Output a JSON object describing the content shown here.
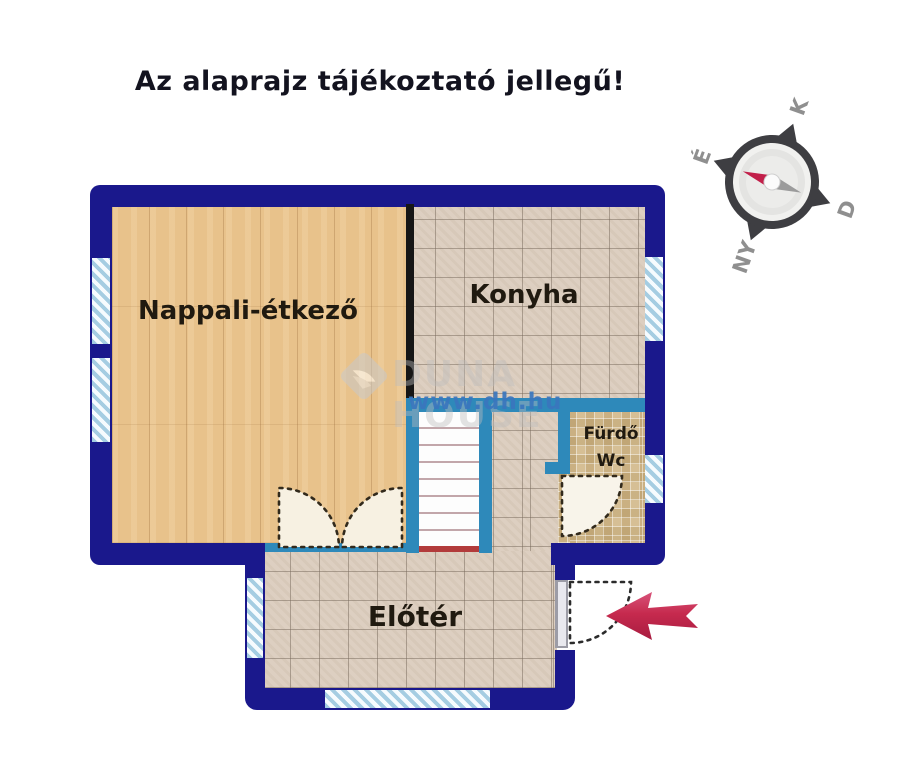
{
  "title": "Az alaprajz tájékoztató jellegű!",
  "compass": {
    "labels": {
      "north": "É",
      "east": "K",
      "south": "D",
      "west": "NY"
    },
    "needle_color": "#c2204a"
  },
  "rooms": {
    "living": {
      "label": "Nappali-étkező",
      "floor": "wood"
    },
    "kitchen": {
      "label": "Konyha",
      "floor": "tile"
    },
    "bathroom": {
      "label_line1": "Fürdő",
      "label_line2": "Wc",
      "floor": "mosaic"
    },
    "hall": {
      "label": "Előtér",
      "floor": "tile"
    }
  },
  "watermark": {
    "brand": "DUNA HOUSE",
    "site": "www.dh.hu"
  },
  "colors": {
    "outer_wall": "#1a188c",
    "interior_wall": "#2e89ba",
    "divider_wall": "#161616",
    "window": "#a5cde2",
    "wood_floor": "#e8c28b",
    "tile_floor": "#ddcfc1",
    "mosaic_floor": "#d6bf95",
    "stair_edge": "#b23b3b",
    "entrance_arrow": "#c62a4e"
  }
}
